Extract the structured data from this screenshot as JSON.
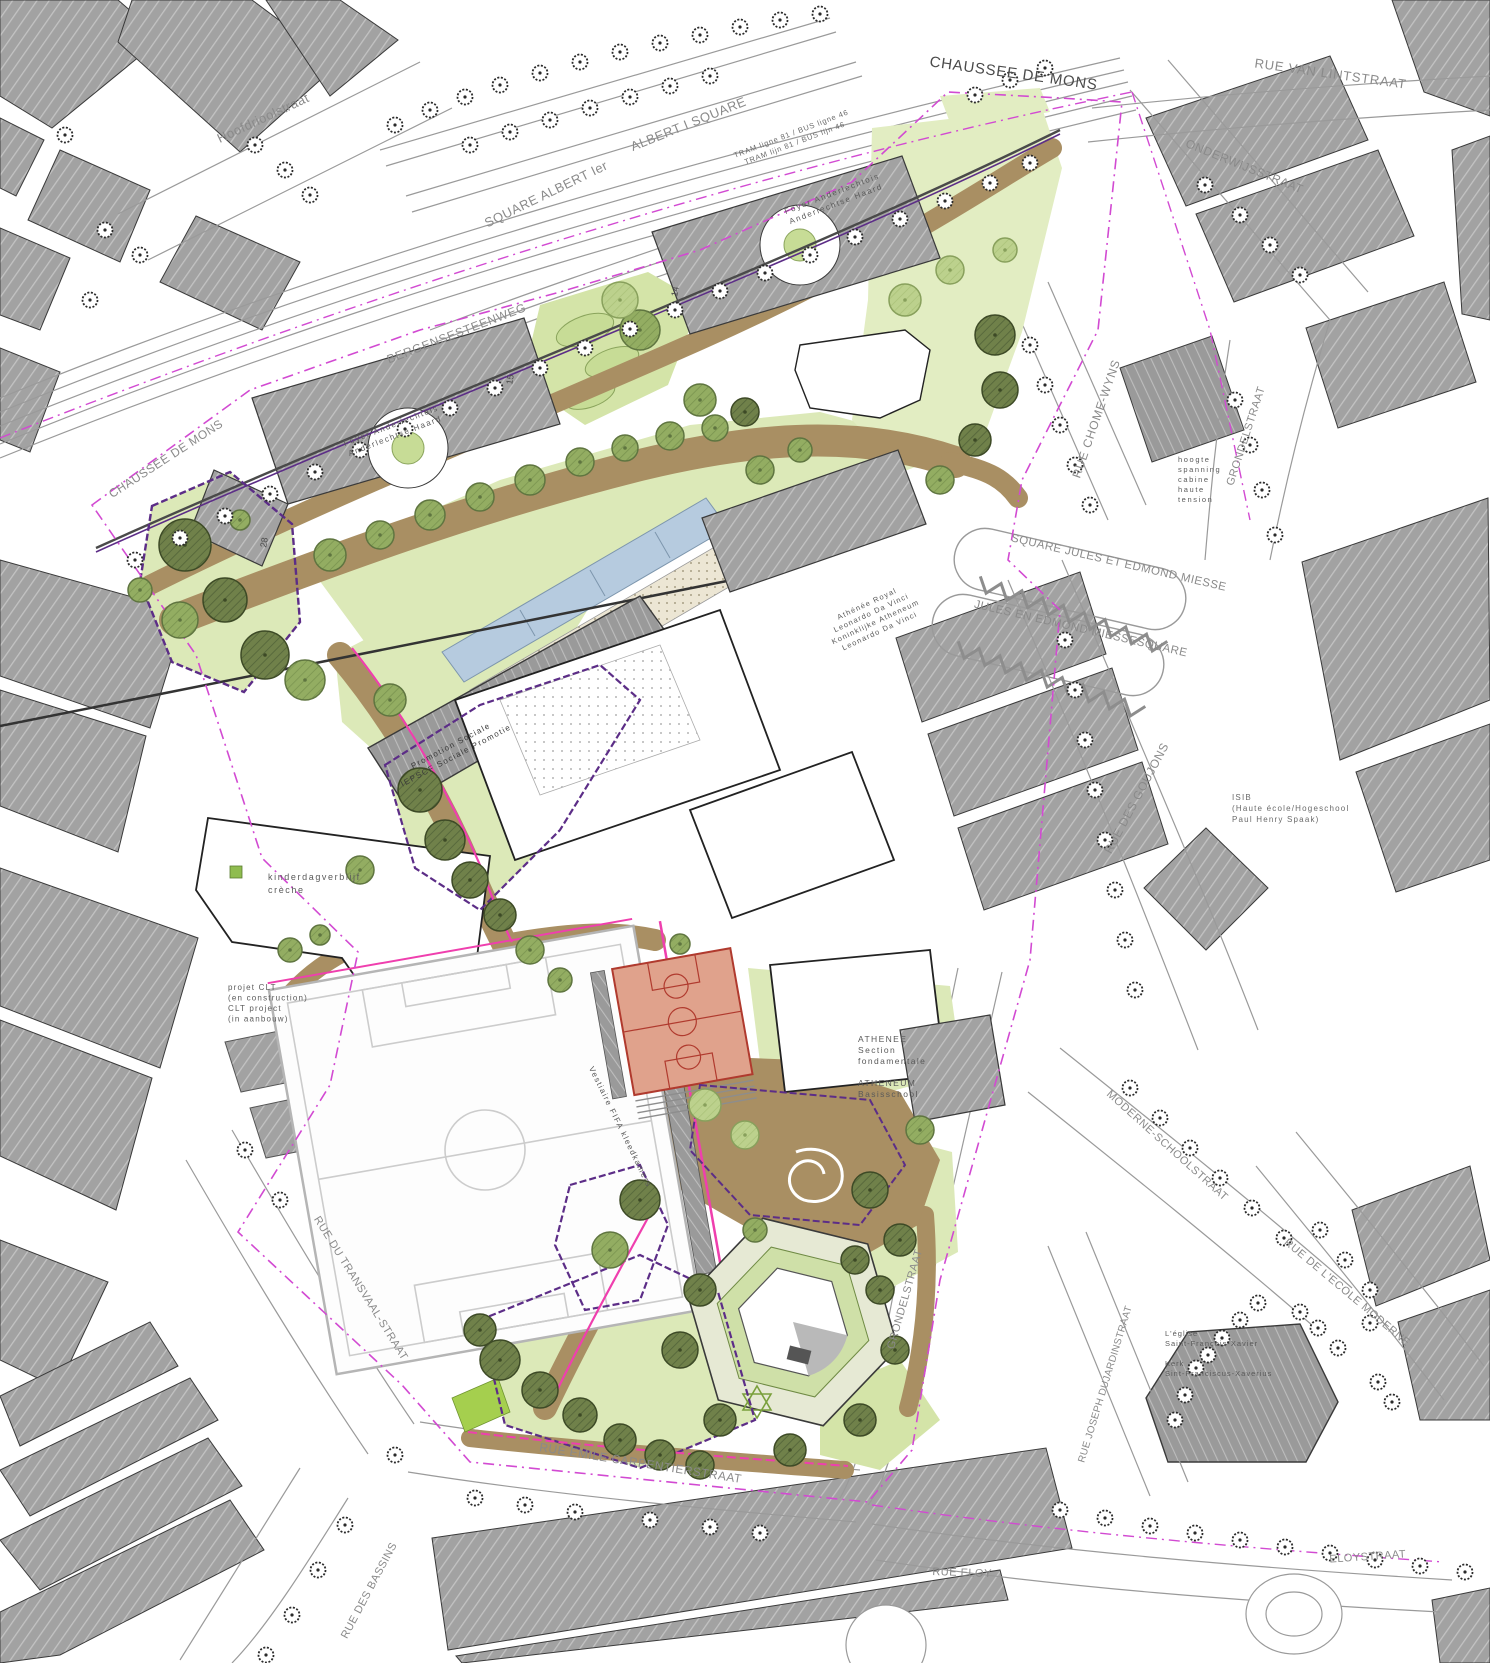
{
  "map_type": "landscape-architecture-site-plan",
  "colors": {
    "background": "#ffffff",
    "context_building_gray": "#a2a2a2",
    "building_outline": "#3a3a3a",
    "lawn_green": "#dce9b8",
    "lawn_light": "#e4eec6",
    "bright_green": "#a5cf4e",
    "path_brown": "#a98f63",
    "tree_dark_olive": "#70814a",
    "tree_medium": "#93ad62",
    "tree_light": "#bcd18d",
    "water_blue": "#b6cbdf",
    "gravel_cream": "#ece6d4",
    "sport_court_salmon": "#e0a28c",
    "court_line_red": "#b03a2e",
    "boundary_magenta": "#d24ad2",
    "accent_pink": "#ef3fae",
    "accent_purple": "#5c2d87",
    "street_label_gray": "#8a8a8a",
    "text_dark": "#4a4a4a"
  },
  "labels": [
    {
      "id": "chaussee-de-mons-top",
      "lines": [
        "CHAUSSEE DE MONS"
      ],
      "x": 1013,
      "y": 78,
      "rot": 8,
      "size": 15,
      "ls": 0.8,
      "color": "#4a4a4a",
      "anchor": "middle"
    },
    {
      "id": "rue-van-lintstraat",
      "lines": [
        "RUE VAN LINTSTRAAT"
      ],
      "x": 1330,
      "y": 78,
      "rot": 8,
      "size": 13,
      "ls": 0.8,
      "color": "#8a8a8a",
      "anchor": "middle"
    },
    {
      "id": "hoofdrioolstraat",
      "lines": [
        "Hoofdrioolstraat"
      ],
      "x": 265,
      "y": 122,
      "rot": -25,
      "size": 13,
      "ls": 0.5,
      "color": "#8a8a8a",
      "anchor": "middle"
    },
    {
      "id": "square-albert-ier",
      "lines": [
        "SQUARE ALBERT Ier"
      ],
      "x": 548,
      "y": 198,
      "rot": -26,
      "size": 13,
      "ls": 0.5,
      "color": "#8a8a8a",
      "anchor": "middle"
    },
    {
      "id": "albert-i-square",
      "lines": [
        "ALBERT I SQUARE"
      ],
      "x": 690,
      "y": 128,
      "rot": -22,
      "size": 13,
      "ls": 0.5,
      "color": "#8a8a8a",
      "anchor": "middle"
    },
    {
      "id": "tram-bus-lines",
      "lines": [
        "TRAM ligne 81 / BUS ligne 46",
        "TRAM lijn 81 / BUS lijn 46"
      ],
      "x": 792,
      "y": 136,
      "rot": -21,
      "size": 7.5,
      "ls": 0.8,
      "color": "#6a6a6a",
      "anchor": "middle",
      "lh": 10
    },
    {
      "id": "bergensesteenweg",
      "lines": [
        "BERGENSESTEENWEG"
      ],
      "x": 458,
      "y": 337,
      "rot": -21,
      "size": 12,
      "ls": 0.8,
      "color": "#8a8a8a",
      "anchor": "middle"
    },
    {
      "id": "chaussee-de-mons-left",
      "lines": [
        "CHAUSSEE DE MONS"
      ],
      "x": 168,
      "y": 462,
      "rot": -33,
      "size": 12,
      "ls": 0.5,
      "color": "#8a8a8a",
      "anchor": "middle"
    },
    {
      "id": "foyer-anderlechtois-north",
      "lines": [
        "Foyer Anderlechtois",
        "Anderlechtse Haard"
      ],
      "x": 833,
      "y": 196,
      "rot": -21,
      "size": 8,
      "ls": 1.6,
      "color": "#5a5a5a",
      "anchor": "middle",
      "lh": 11
    },
    {
      "id": "foyer-anderlechtois-west",
      "lines": [
        "Foyer Anderlechtois",
        "Anderlechtse Haard"
      ],
      "x": 392,
      "y": 428,
      "rot": -21,
      "size": 8,
      "ls": 1.6,
      "color": "#5a5a5a",
      "anchor": "middle",
      "lh": 11
    },
    {
      "id": "rue-chome-wyns",
      "lines": [
        "RUE CHOME-WYNS"
      ],
      "x": 1100,
      "y": 420,
      "rot": -71,
      "size": 12,
      "ls": 0.8,
      "color": "#8a8a8a",
      "anchor": "middle"
    },
    {
      "id": "hoogspanning-cabine",
      "lines": [
        "hoogte",
        "spanning",
        "cabine",
        "haute",
        "tension"
      ],
      "x": 1178,
      "y": 462,
      "rot": 0,
      "size": 7.5,
      "ls": 1.6,
      "color": "#5a5a5a",
      "anchor": "start",
      "lh": 10
    },
    {
      "id": "square-jules-et-edmond-miesse",
      "lines": [
        "SQUARE JULES ET EDMOND MIESSE"
      ],
      "x": 1118,
      "y": 566,
      "rot": 13,
      "size": 11.5,
      "ls": 0.5,
      "color": "#8a8a8a",
      "anchor": "middle"
    },
    {
      "id": "jules-en-edmond-miessesquare",
      "lines": [
        "JULES EN EDMOND MIESSESQUARE"
      ],
      "x": 1080,
      "y": 632,
      "rot": 13,
      "size": 11.5,
      "ls": 0.5,
      "color": "#8a8a8a",
      "anchor": "middle"
    },
    {
      "id": "onderwijsstraat",
      "lines": [
        "ONDERWIJSSTRAAT"
      ],
      "x": 1243,
      "y": 170,
      "rot": 22,
      "size": 12,
      "ls": 0.5,
      "color": "#8a8a8a",
      "anchor": "middle"
    },
    {
      "id": "grondelstraat-north",
      "lines": [
        "GRONDELSTRAAT"
      ],
      "x": 1249,
      "y": 437,
      "rot": -72,
      "size": 11,
      "ls": 0.5,
      "color": "#8a8a8a",
      "anchor": "middle"
    },
    {
      "id": "rue-des-goujons",
      "lines": [
        "RUE DES GOUJONS"
      ],
      "x": 1140,
      "y": 800,
      "rot": -62,
      "size": 12,
      "ls": 0.5,
      "color": "#8a8a8a",
      "anchor": "middle"
    },
    {
      "id": "isib-haute-ecole",
      "lines": [
        "ISIB",
        "(Haute école/Hogeschool",
        "Paul Henry Spaak)"
      ],
      "x": 1232,
      "y": 800,
      "rot": 0,
      "size": 8,
      "ls": 1.2,
      "color": "#6a6a6a",
      "anchor": "start",
      "lh": 11
    },
    {
      "id": "moderne-schoolstraat",
      "lines": [
        "MODERNE-SCHOOLSTRAAT"
      ],
      "x": 1165,
      "y": 1148,
      "rot": 42,
      "size": 11,
      "ls": 0.5,
      "color": "#8a8a8a",
      "anchor": "middle"
    },
    {
      "id": "rue-joseph-dujardinstraat",
      "lines": [
        "RUE JOSEPH DUJARDINSTRAAT"
      ],
      "x": 1108,
      "y": 1385,
      "rot": -73,
      "size": 10,
      "ls": 0.3,
      "color": "#8a8a8a",
      "anchor": "middle"
    },
    {
      "id": "eglise-saint-francois-xavier",
      "lines": [
        "L'église",
        "Saint-François-Xavier",
        "",
        "Kerk",
        "Sint-Franciscus-Xaverius"
      ],
      "x": 1165,
      "y": 1336,
      "rot": 0,
      "size": 7.5,
      "ls": 1,
      "color": "#5a5a5a",
      "anchor": "start",
      "lh": 10
    },
    {
      "id": "rue-de-l-ecole-moderne",
      "lines": [
        "RUE DE L'ECOLE MODERNE"
      ],
      "x": 1345,
      "y": 1295,
      "rot": 40,
      "size": 11,
      "ls": 0.5,
      "color": "#8a8a8a",
      "anchor": "middle"
    },
    {
      "id": "rue-du-transvaal-straat",
      "lines": [
        "RUE DU TRANSVAAL-STRAAT"
      ],
      "x": 358,
      "y": 1290,
      "rot": 58,
      "size": 11,
      "ls": 0.5,
      "color": "#8a8a8a",
      "anchor": "middle"
    },
    {
      "id": "rue-emile-carpentierstraat",
      "lines": [
        "RUE EMILE CARPENTIERSTRAAT"
      ],
      "x": 640,
      "y": 1467,
      "rot": 9,
      "size": 12,
      "ls": 0.5,
      "color": "#8a8a8a",
      "anchor": "middle"
    },
    {
      "id": "rue-eloy",
      "lines": [
        "RUE ELOY"
      ],
      "x": 962,
      "y": 1576,
      "rot": 2,
      "size": 11,
      "ls": 0.5,
      "color": "#8a8a8a",
      "anchor": "middle"
    },
    {
      "id": "eloystraat",
      "lines": [
        "ELOYSTRAAT"
      ],
      "x": 1368,
      "y": 1560,
      "rot": -4,
      "size": 11,
      "ls": 0.5,
      "color": "#8a8a8a",
      "anchor": "middle"
    },
    {
      "id": "rue-des-bassins",
      "lines": [
        "RUE DES BASSINS"
      ],
      "x": 372,
      "y": 1592,
      "rot": -62,
      "size": 11,
      "ls": 0.5,
      "color": "#8a8a8a",
      "anchor": "middle"
    },
    {
      "id": "grondelstraat-south",
      "lines": [
        "GRONDELSTRAAT"
      ],
      "x": 908,
      "y": 1300,
      "rot": -74,
      "size": 11,
      "ls": 0.5,
      "color": "#8a8a8a",
      "anchor": "middle"
    },
    {
      "id": "athenee-royal-leonardo-da-vinci",
      "lines": [
        "Athénée Royal",
        "Leonardo Da Vinci",
        "Koninklijke Atheneum",
        "Leonardo Da Vinci"
      ],
      "x": 868,
      "y": 606,
      "rot": -25,
      "size": 7.5,
      "ls": 1.2,
      "color": "#5a5a5a",
      "anchor": "middle",
      "lh": 10
    },
    {
      "id": "promotion-sociale",
      "lines": [
        "Promotion Sociale",
        "IEPSCF Sociale Promotie"
      ],
      "x": 452,
      "y": 748,
      "rot": -28,
      "size": 8,
      "ls": 1.4,
      "color": "#3a3a3a",
      "anchor": "middle",
      "lh": 11
    },
    {
      "id": "kinderdagverblijf-creche",
      "lines": [
        "kinderdagverblijf",
        "crèche"
      ],
      "x": 268,
      "y": 880,
      "rot": 0,
      "size": 9,
      "ls": 1.6,
      "color": "#5a5a5a",
      "anchor": "start",
      "lh": 13
    },
    {
      "id": "projet-clt",
      "lines": [
        "projet CLT",
        "(en construction)",
        "CLT project",
        "(in aanbouw)"
      ],
      "x": 228,
      "y": 990,
      "rot": 0,
      "size": 8,
      "ls": 1.2,
      "color": "#5a5a5a",
      "anchor": "start",
      "lh": 10.5
    },
    {
      "id": "athenee-section-fondamentale",
      "lines": [
        "ATHENEE",
        "Section",
        "fondamentale",
        "",
        "ATHENEUM",
        "Basisschool"
      ],
      "x": 858,
      "y": 1042,
      "rot": 0,
      "size": 8.5,
      "ls": 1.4,
      "color": "#5a5a5a",
      "anchor": "start",
      "lh": 11
    },
    {
      "id": "vestiaire-fifa",
      "lines": [
        "Vestiaire FIFA kleedkamers"
      ],
      "x": 618,
      "y": 1128,
      "rot": 64,
      "size": 8,
      "ls": 1.4,
      "color": "#5a5a5a",
      "anchor": "middle"
    },
    {
      "id": "building-number-14",
      "lines": [
        "14"
      ],
      "x": 678,
      "y": 292,
      "rot": -80,
      "size": 9,
      "ls": 0,
      "color": "#4a4a4a",
      "anchor": "middle"
    },
    {
      "id": "building-number-15",
      "lines": [
        "15"
      ],
      "x": 513,
      "y": 380,
      "rot": -80,
      "size": 9,
      "ls": 0,
      "color": "#4a4a4a",
      "anchor": "middle"
    },
    {
      "id": "building-number-28",
      "lines": [
        "28"
      ],
      "x": 267,
      "y": 543,
      "rot": -80,
      "size": 9,
      "ls": 0,
      "color": "#4a4a4a",
      "anchor": "middle"
    }
  ]
}
